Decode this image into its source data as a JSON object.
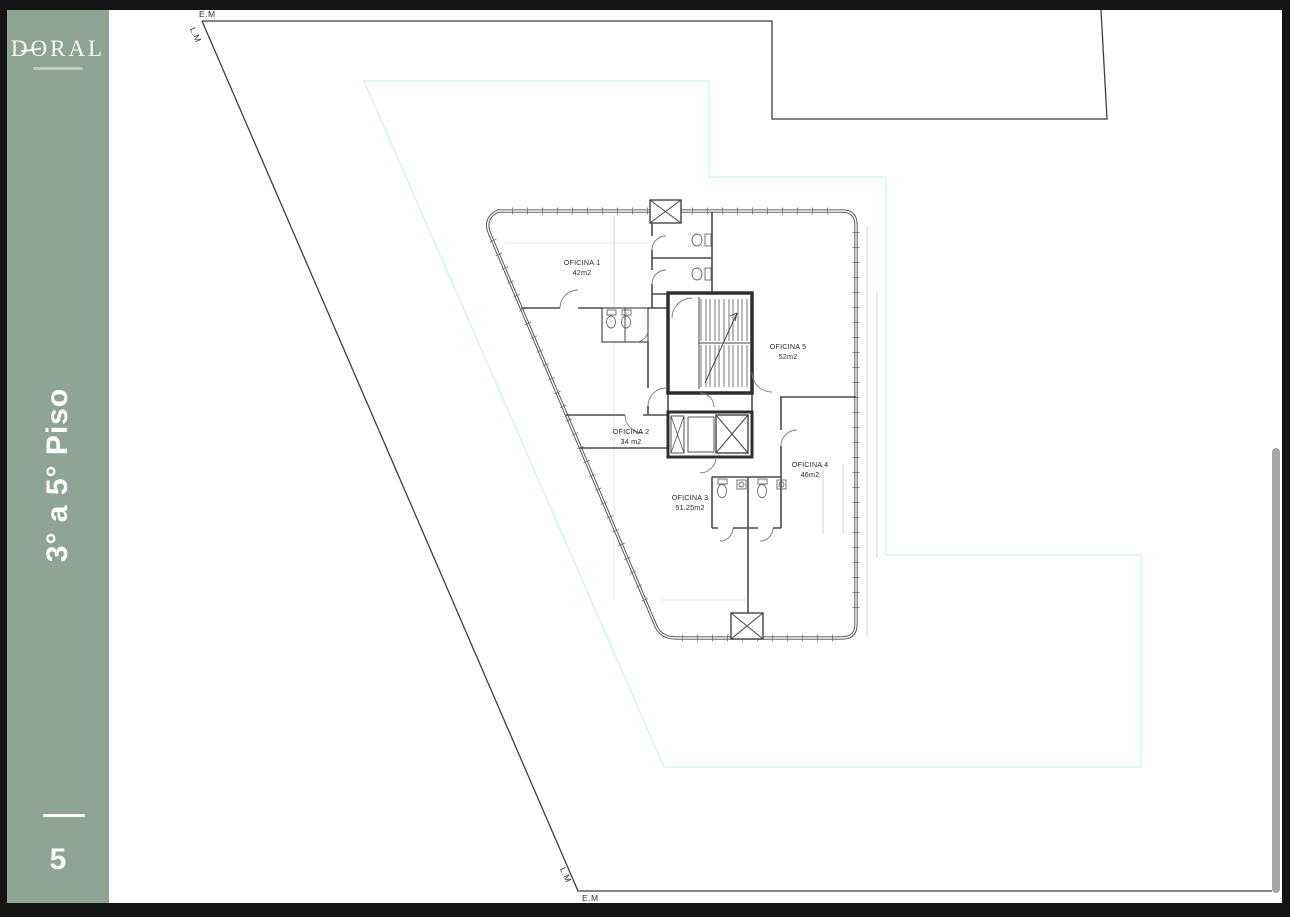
{
  "colors": {
    "frame": "#141414",
    "page": "#ffffff",
    "sidebar": "#8ea596",
    "site_line": "#3e3e3e",
    "setback_line": "#bdebe7",
    "scrollbar": "#a6a6a6"
  },
  "sidebar": {
    "logo": "DORAL",
    "floor_label": "3° a 5° Piso",
    "page_number": "5"
  },
  "boundary_labels": {
    "em_top": "E.M",
    "lm_top": "L.M",
    "lm_bottom": "L.M",
    "em_bottom": "E.M"
  },
  "plan": {
    "offices": [
      {
        "name": "OFICINA 1",
        "area": "42m2"
      },
      {
        "name": "OFICINA 2",
        "area": "34 m2"
      },
      {
        "name": "OFICINA 3",
        "area": "51.25m2"
      },
      {
        "name": "OFICINA 4",
        "area": "46m2"
      },
      {
        "name": "OFICINA 5",
        "area": "52m2"
      }
    ]
  }
}
